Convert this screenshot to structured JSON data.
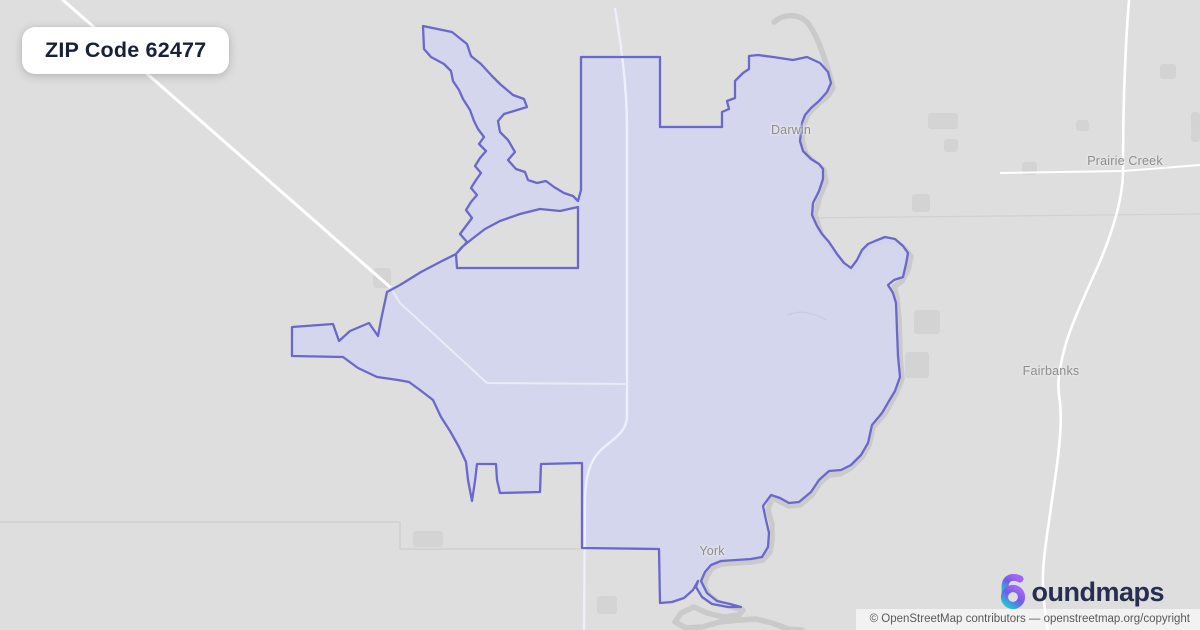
{
  "badge": {
    "title": "ZIP Code 62477"
  },
  "map": {
    "background_color": "#dedede",
    "boundary_stroke": "#6a68cc",
    "boundary_fill": "#d2d5ee",
    "river_color": "#c7c7c7",
    "road_color": "#ffffff",
    "inner_road_color": "#edeffa",
    "county_line_color": "#cfcfcf",
    "boundary_path": "M423,26 L452,32 467,44 471,56 481,64 492,76 500,84 513,95 524,99 527,107 514,111 504,114 498,121 500,132 508,140 515,152 508,160 516,169 525,172 528,180 537,183 546,181 554,187 564,193 573,196 578,201 581,190 581,57 660,57 660,127 722,127 722,112 729,109 727,101 735,98 735,81 743,73 749,69 749,56 758,55 773,57 793,60 807,57 820,63 828,72 831,83 827,92 819,101 811,108 805,115 802,123 801,132 800,141 803,151 811,159 819,164 823,169 823,179 819,191 813,203 812,215 817,226 822,234 829,242 837,254 844,263 851,268 857,260 862,250 868,244 875,241 885,237 895,239 903,246 908,253 906,264 903,277 894,280 888,285 893,293 896,303 897,331 898,356 900,377 895,391 889,401 882,413 872,425 868,443 861,455 851,465 841,470 829,471 819,480 811,492 799,502 789,503 780,498 771,495 763,506 766,520 769,533 768,547 762,557 751,559 736,560 721,561 711,565 705,572 701,581 707,593 717,601 730,604 741,607 728,607 712,604 702,597 696,587 698,581 693,590 684,598 672,602 660,603 659,549 582,548 582,463 541,464 540,492 500,493 497,480 496,464 477,464 475,481 472,501 468,480 466,462 459,447 450,431 441,417 433,400 420,390 409,382 398,380 377,377 358,368 343,357 292,356 292,327 333,324 339,341 350,331 369,323 378,336 381,320 387,292 400,285 421,272 442,261 456,254 457,268 578,268 578,207 560,211 540,209 520,214 500,221 485,229 472,239 462,247 456,254 467,242 460,234 466,226 472,218 466,210 471,202 477,195 471,188 476,180 481,173 475,166 480,158 486,151 479,144 484,137 478,129 474,121 470,110 463,99 459,90 453,81 451,71 444,64 431,57 424,49 Z",
    "river_path": "M774,22 C786,12 802,14 810,26 C818,38 824,56 830,76 L833,88 828,96 818,104 808,114 804,124 802,140 806,154 814,162 824,170 826,182 820,196 815,214 821,234 832,250 844,265 853,271 L859,262 866,250 876,244 886,240 896,242 905,249 911,256 908,270 902,281 894,287 897,297 899,320 900,355 902,379 896,394 884,415 873,427 869,445 862,457 851,468 840,474 829,475 820,483 812,495 800,505 789,506 779,501 772,498 768,510 772,524 772,540 770,552 763,560 751,562 735,563 721,564 712,568 707,576 704,585 709,595 719,603 732,607 743,610 L739,615 724,617 707,613 694,607 681,613 675,622 686,628 702,627 720,622 740,620 756,619 772,623 788,629 802,630",
    "roads": {
      "nw_diagonal": "M63,0 L390,287",
      "inner_diagonal": "M390,287 L400,303 487,383 625,384",
      "central": "M615,8 C621,45 627,85 627,130 L627,416 C627,434 609,441 599,452 C589,463 586,477 585,497 L584,630",
      "east_vertical": "M1129,0 C1125,50 1123,110 1123,171 C1123,203 1108,245 1093,277 C1080,306 1069,331 1065,347 C1058,372 1057,387 1060,402 C1063,432 1056,472 1051,507 C1047,537 1042,562 1043,587 C1044,607 1046,620 1048,630",
      "east_horizontal": "M1000,173 L1123,171 1200,165"
    },
    "county_line_1": "M0,522 L400,522 400,549 580,549",
    "county_line_2": "M803,218 L1200,214",
    "stream_path": "M788,315 C800,310 812,312 826,320",
    "patches": [
      {
        "x": 928,
        "y": 113,
        "w": 30,
        "h": 16
      },
      {
        "x": 944,
        "y": 139,
        "w": 14,
        "h": 13
      },
      {
        "x": 912,
        "y": 194,
        "w": 18,
        "h": 18
      },
      {
        "x": 1160,
        "y": 64,
        "w": 16,
        "h": 15
      },
      {
        "x": 1076,
        "y": 120,
        "w": 13,
        "h": 11
      },
      {
        "x": 1191,
        "y": 112,
        "w": 9,
        "h": 30
      },
      {
        "x": 914,
        "y": 310,
        "w": 26,
        "h": 24
      },
      {
        "x": 905,
        "y": 352,
        "w": 24,
        "h": 26
      },
      {
        "x": 1022,
        "y": 162,
        "w": 15,
        "h": 13
      },
      {
        "x": 373,
        "y": 268,
        "w": 18,
        "h": 20
      },
      {
        "x": 413,
        "y": 531,
        "w": 30,
        "h": 16
      },
      {
        "x": 597,
        "y": 596,
        "w": 20,
        "h": 18
      }
    ],
    "labels": [
      {
        "text": "Darwin"
      },
      {
        "text": "Prairie Creek"
      },
      {
        "text": "Fairbanks"
      },
      {
        "text": "York"
      }
    ]
  },
  "logo": {
    "wordmark": "oundmaps",
    "accent_purple": "#a266f5",
    "accent_teal": "#23c3d4",
    "text_color": "#272e4e"
  },
  "attribution": {
    "text": "© OpenStreetMap contributors — openstreetmap.org/copyright"
  }
}
